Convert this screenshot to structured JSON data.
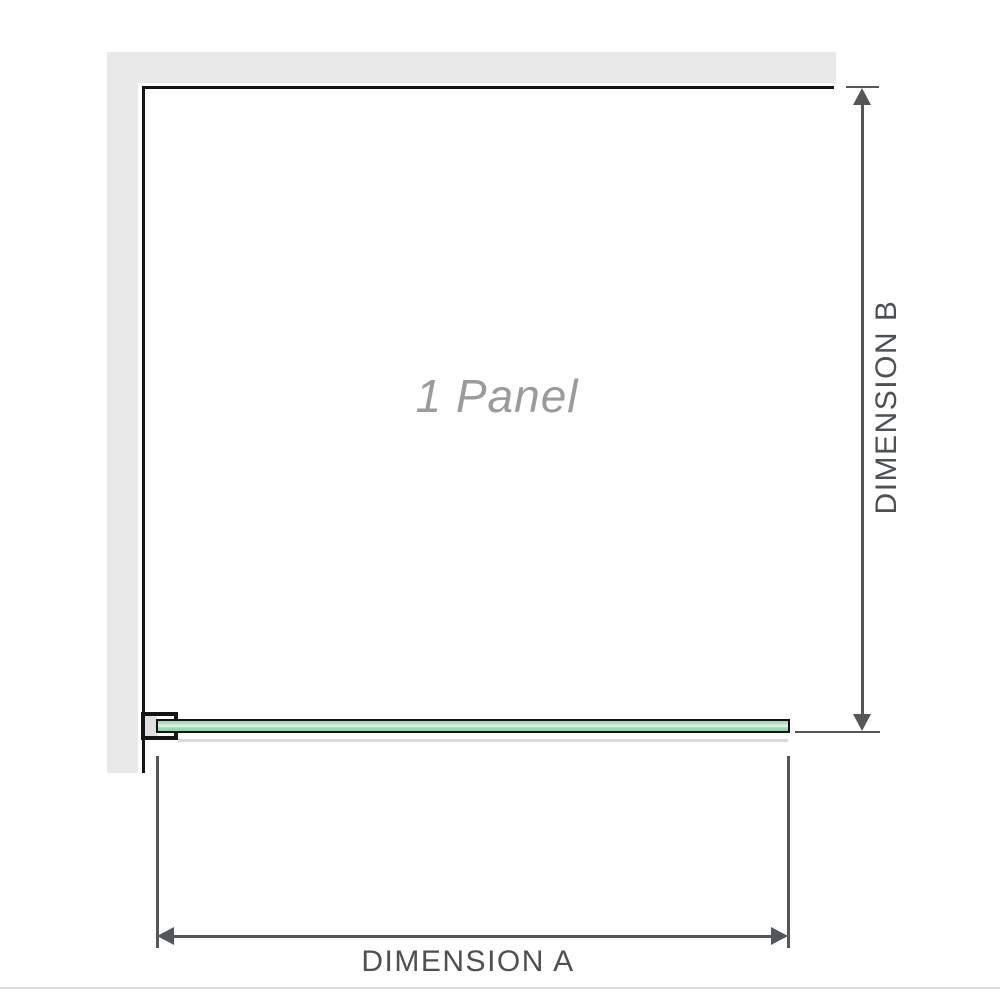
{
  "diagram": {
    "panel_label": "1 Panel",
    "dimensions": {
      "a": {
        "label": "DIMENSION A"
      },
      "b": {
        "label": "DIMENSION B"
      }
    }
  },
  "colors": {
    "wall_gray": "#e9e9e9",
    "outline_black": "#141414",
    "dimension_gray": "#54575a",
    "dimension_text_gray": "#4d5154",
    "panel_label_gray": "#9b9b9b",
    "glass_green": "#a5dbb8",
    "glass_highlight": "#e9f8ef",
    "bracket_fill_gray": "#e0e0e0",
    "shadow_gray": "#d8d8d8",
    "divider_gray": "#dcdcdc"
  }
}
